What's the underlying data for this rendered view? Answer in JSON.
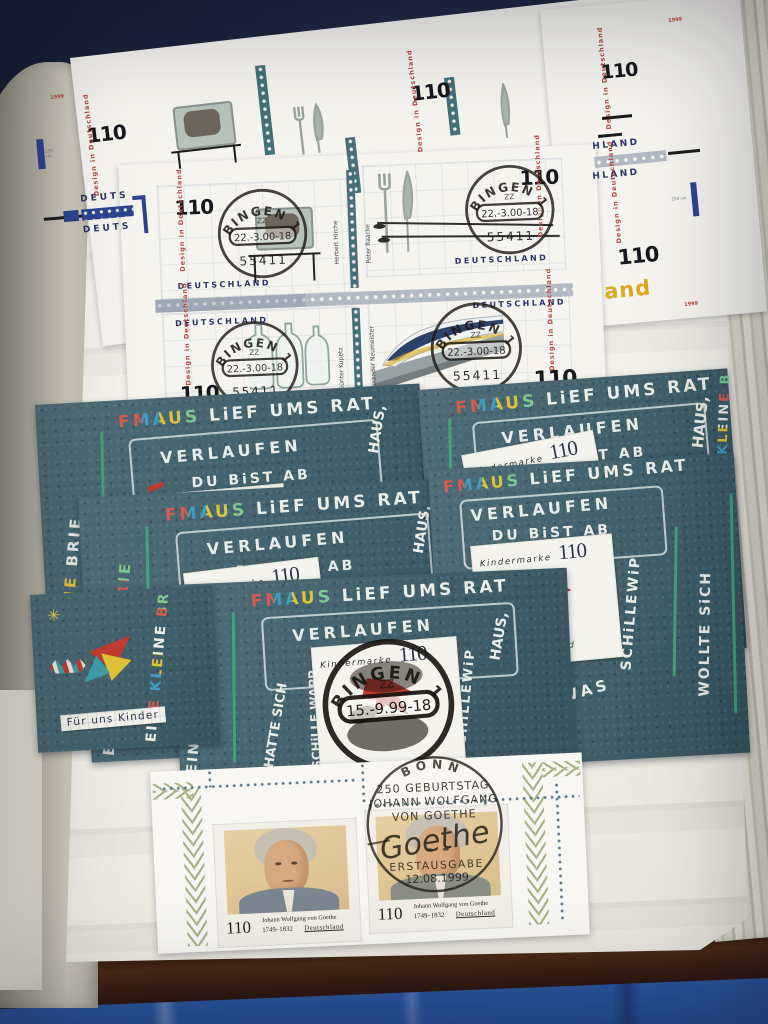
{
  "album": {
    "design_series": {
      "value": "110",
      "series": "Design in Deutschland",
      "country": "DEUTSCHLAND",
      "country_partial": "HLAND",
      "margin_word_partial": "DEUTS",
      "margin_and": "and",
      "year_mark": "1999",
      "ruler_label": "250 cm",
      "designers": [
        "Herbert Hirche",
        "Peter Raacke",
        "Günter Kupetz",
        "Alexander Neumeister"
      ],
      "postmark": {
        "town": "BINGEN 1",
        "letters": "ZZ",
        "date": "22.-3.00-18",
        "postcode": "55411"
      }
    },
    "kinder": {
      "story_top": "FMAUS LiEF UMS RAT",
      "story_verlaufen": "VERLAUFEN",
      "story_dubist": "DU BiST AB",
      "story_left_outer": "EINE KLEINE BRIE",
      "story_hatte": "HATTE SICH",
      "story_schille": "SCHiLLE WAPP",
      "story_ich": "ICH",
      "story_haus": "HAUS,",
      "story_schillewip": "SCHiLLEWiP",
      "story_wollte": "WOLLTE SiCH",
      "story_was": "WAS",
      "stamp_label": "Kindermarke",
      "stamp_value": "110",
      "stamp_country": "Deutschland",
      "legend": "Für uns Kinder",
      "legend_partial": "Fü",
      "postmark": {
        "town": "BINGEN 1",
        "letters": "ZZ",
        "date": "15.-9.99-18"
      }
    },
    "goethe": {
      "value": "110",
      "name": "Johann Wolfgang von Goethe",
      "years": "1749–1832",
      "country": "Deutschland",
      "postmark": {
        "town": "BONN",
        "line1": "250 GEBURTSTAG",
        "line2": "JOHANN WOLFGANG",
        "line3": "VON GOETHE",
        "signature": "Goethe",
        "line4": "ERSTAUSGABE",
        "date": "12.08.1999"
      }
    }
  },
  "colors": {
    "page": "#f4f2ec",
    "teal_sheet": "#41626e",
    "accent_red": "#b5483f",
    "navy": "#2a3568",
    "laurel_green": "#a9b489",
    "cover_blue": "#2e59a4",
    "postmark_ink": "#1f1c18"
  }
}
